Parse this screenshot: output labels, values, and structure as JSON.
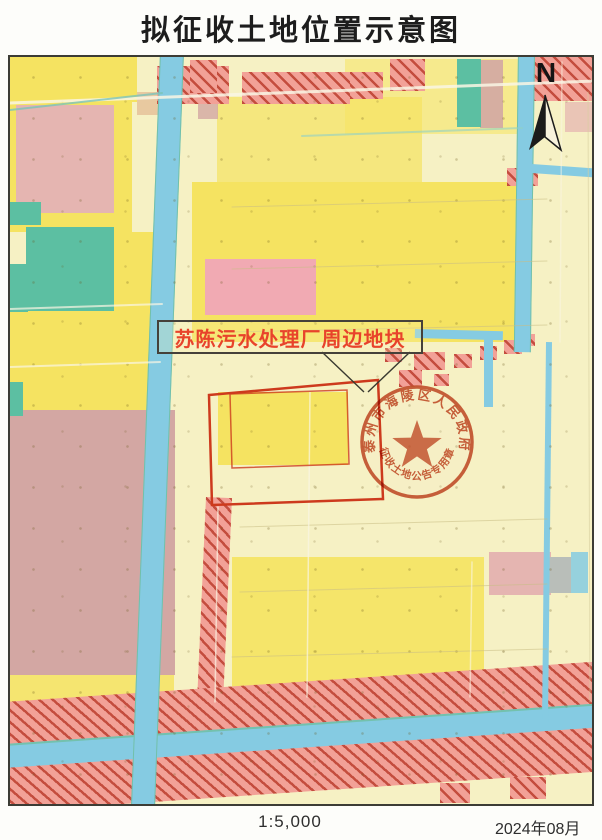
{
  "title": "拟征收土地位置示意图",
  "map": {
    "area_label": "苏陈污水处理厂周边地块",
    "north_indicator": "N",
    "seal": {
      "top_text": "泰州市海陵区人民政府",
      "bottom_text": "征收土地公告专用章"
    }
  },
  "footer": {
    "scale": "1:5,000",
    "date": "2024年08月"
  },
  "palette": {
    "paleYellow": "#f6f1c4",
    "brightYellow": "#f5e361",
    "pink": "#e5b5b1",
    "pinkBright": "#f1aab3",
    "mauve": "#d3a7a3",
    "teal": "#5cbfa2",
    "canalBlue": "#85cbe2",
    "hatchFill": "#f2a197",
    "hatchLine": "#c44d3e",
    "darkRed": "#bf504a",
    "outlineRed": "#cd3a1d",
    "sealRed": "#c0512c",
    "labelRed": "#e8432b",
    "gray": "#b9beb9",
    "buff": "#e8c9a0"
  }
}
